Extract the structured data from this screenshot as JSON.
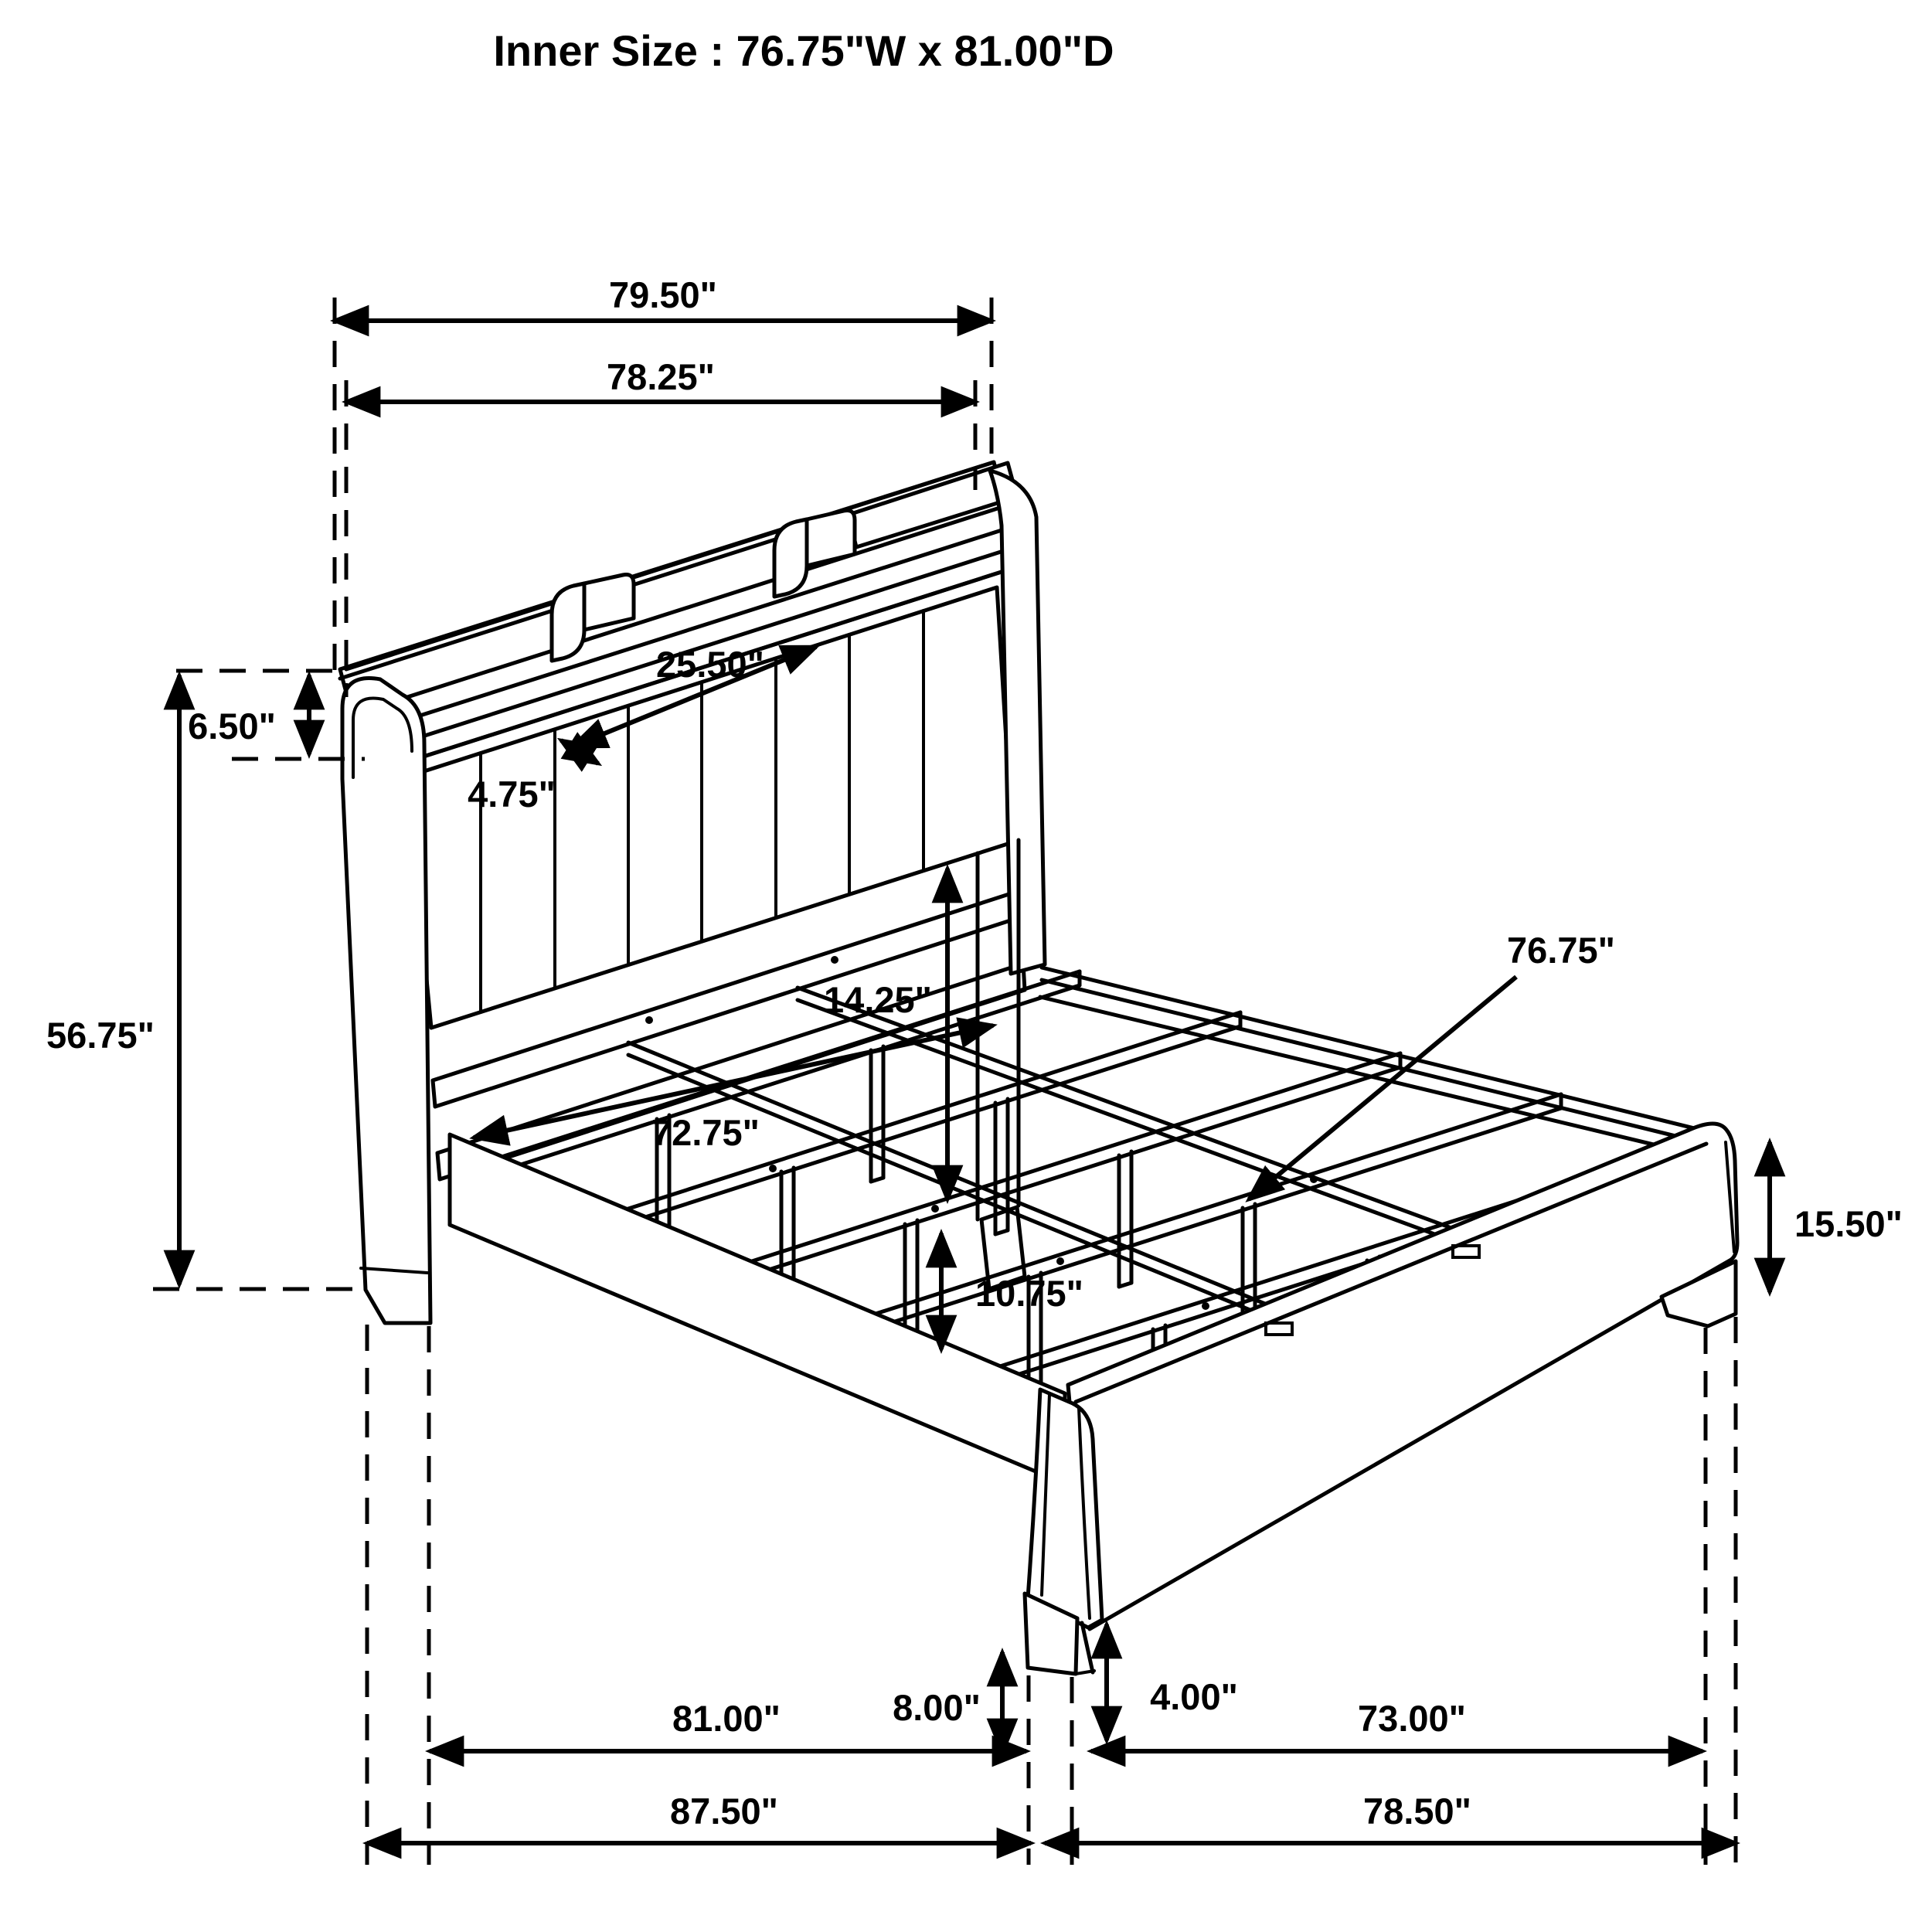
{
  "title": "Inner Size : 76.75\"W x 81.00\"D",
  "colors": {
    "ink": "#000000",
    "paper": "#ffffff"
  },
  "dimensions": {
    "headboard_outer_width": "79.50\"",
    "headboard_shelf_width": "78.25\"",
    "shelf_compartment_width": "25.50\"",
    "shelf_compartment_depth": "4.75\"",
    "shelf_height": "6.50\"",
    "headboard_height": "56.75\"",
    "panel_to_slat_gap": "14.25\"",
    "headboard_inner_width": "72.75\"",
    "slat_length": "76.75\"",
    "footboard_height": "15.50\"",
    "support_leg_height": "10.75\"",
    "frame_floor_clearance": "8.00\"",
    "footboard_leg_height": "4.00\"",
    "inner_depth": "81.00\"",
    "footboard_inner_span": "73.00\"",
    "overall_depth": "87.50\"",
    "footboard_outer_span": "78.50\""
  }
}
